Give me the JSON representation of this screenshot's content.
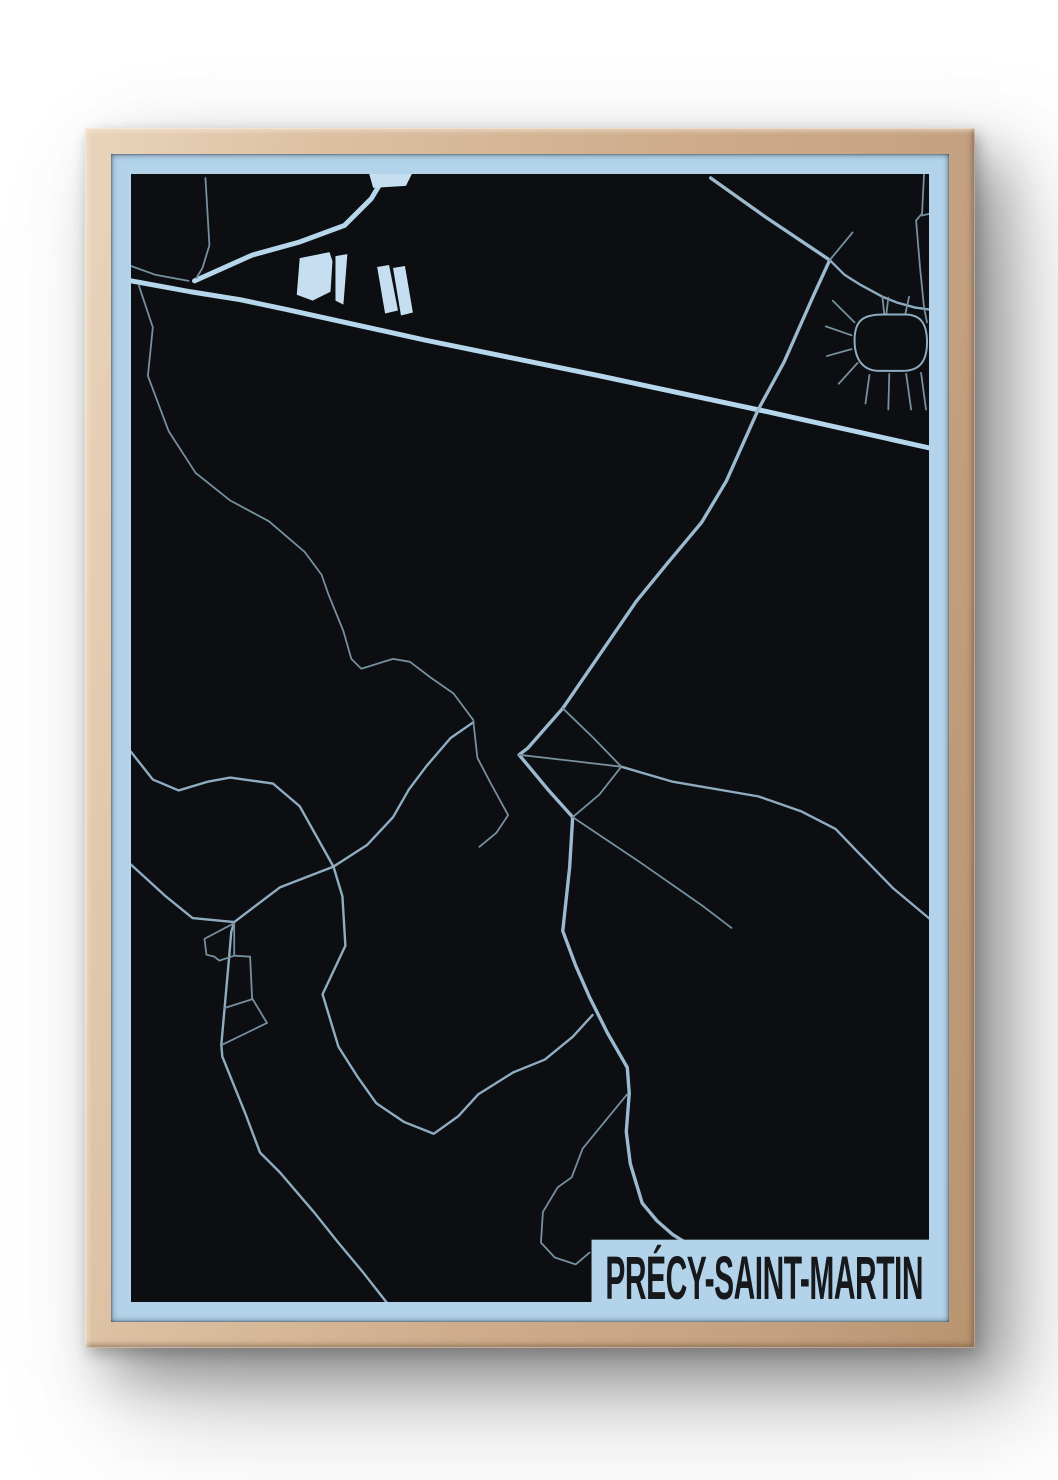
{
  "poster": {
    "title": "PRÉCY-SAINT-MARTIN",
    "type_label": "framed-city-map-poster",
    "colors": {
      "page_bg": "#ffffff",
      "frame_wood": "#cdab8b",
      "frame_wood_light": "#e9d4bc",
      "frame_wood_dark": "#b8946f",
      "matte_blue": "#b2d3ea",
      "map_black": "#0c0e11",
      "road_major": "#b6d7eb",
      "road_medium": "#9cbacf",
      "road_small": "#8fadc2",
      "road_minor": "#76909f",
      "building_fill": "#c6dff0",
      "band_bg": "#b2d3ea",
      "title_color": "#16181b"
    },
    "map": {
      "viewbox": "0 0 804 1140",
      "band": {
        "x": 464,
        "y": 1077,
        "w": 341,
        "h": 64
      },
      "title_text": {
        "x": 478,
        "y": 1137,
        "font_size": 62,
        "text_length": 320
      },
      "roads": {
        "major": {
          "width": 5,
          "paths": [
            [
              [
                0,
                108
              ],
              [
                60,
                119
              ],
              [
                110,
                127
              ],
              [
                157,
                137
              ],
              [
                297,
                168
              ],
              [
                472,
                204
              ],
              [
                640,
                240
              ],
              [
                805,
                277
              ]
            ],
            [
              [
                64,
                108
              ],
              [
                122,
                82
              ],
              [
                169,
                69
              ],
              [
                215,
                52
              ],
              [
                242,
                25
              ],
              [
                257,
                0
              ]
            ]
          ]
        },
        "medium": {
          "width": 3.4,
          "paths": [
            [
              [
                584,
                4
              ],
              [
                640,
                44
              ],
              [
                704,
                87
              ],
              [
                688,
                122
              ],
              [
                658,
                190
              ],
              [
                632,
                238
              ],
              [
                600,
                310
              ],
              [
                575,
                352
              ],
              [
                540,
                394
              ],
              [
                509,
                432
              ],
              [
                435,
                540
              ]
            ],
            [
              [
                435,
                540
              ],
              [
                400,
                580
              ],
              [
                391,
                587
              ],
              [
                420,
                622
              ],
              [
                445,
                650
              ],
              [
                442,
                700
              ],
              [
                435,
                765
              ],
              [
                448,
                800
              ],
              [
                462,
                832
              ],
              [
                480,
                868
              ],
              [
                500,
                903
              ],
              [
                502,
                929
              ],
              [
                499,
                968
              ],
              [
                503,
                1000
              ],
              [
                515,
                1040
              ],
              [
                530,
                1058
              ],
              [
                546,
                1072
              ],
              [
                562,
                1082
              ]
            ]
          ]
        },
        "small": {
          "width": 2.4,
          "paths": [
            [
              [
                494,
                599
              ],
              [
                545,
                614
              ],
              [
                632,
                629
              ],
              [
                675,
                644
              ],
              [
                710,
                662
              ],
              [
                732,
                685
              ],
              [
                768,
                722
              ],
              [
                805,
                753
              ]
            ],
            [
              [
                0,
                698
              ],
              [
                35,
                730
              ],
              [
                62,
                752
              ],
              [
                104,
                756
              ],
              [
                150,
                721
              ],
              [
                204,
                700
              ],
              [
                238,
                678
              ],
              [
                264,
                650
              ],
              [
                280,
                622
              ],
              [
                298,
                598
              ],
              [
                322,
                570
              ],
              [
                345,
                554
              ]
            ],
            [
              [
                0,
                584
              ],
              [
                22,
                612
              ],
              [
                48,
                623
              ],
              [
                78,
                614
              ],
              [
                100,
                610
              ],
              [
                143,
                616
              ],
              [
                170,
                639
              ],
              [
                204,
                700
              ],
              [
                213,
                730
              ],
              [
                216,
                780
              ],
              [
                193,
                829
              ],
              [
                209,
                882
              ],
              [
                228,
                912
              ],
              [
                247,
                939
              ],
              [
                275,
                958
              ],
              [
                305,
                970
              ],
              [
                330,
                952
              ],
              [
                350,
                930
              ],
              [
                385,
                908
              ],
              [
                417,
                895
              ],
              [
                445,
                872
              ],
              [
                465,
                850
              ]
            ],
            [
              [
                704,
                87
              ],
              [
                719,
                102
              ],
              [
                735,
                112
              ],
              [
                757,
                124
              ],
              [
                772,
                130
              ],
              [
                790,
                135
              ],
              [
                805,
                137
              ]
            ],
            [
              [
                104,
                756
              ],
              [
                101,
                766
              ],
              [
                99,
                790
              ],
              [
                95,
                835
              ],
              [
                91,
                880
              ],
              [
                92,
                892
              ],
              [
                115,
                949
              ],
              [
                130,
                989
              ],
              [
                150,
                1009
              ],
              [
                185,
                1050
              ],
              [
                208,
                1079
              ],
              [
                233,
                1109
              ],
              [
                258,
                1141
              ]
            ]
          ]
        },
        "minor": {
          "width": 1.8,
          "paths": [
            [
              [
                8,
                113
              ],
              [
                22,
                155
              ],
              [
                17,
                204
              ],
              [
                38,
                260
              ],
              [
                65,
                302
              ],
              [
                100,
                330
              ],
              [
                139,
                351
              ],
              [
                175,
                382
              ],
              [
                192,
                405
              ],
              [
                199,
                425
              ],
              [
                214,
                462
              ],
              [
                222,
                490
              ],
              [
                232,
                500
              ],
              [
                264,
                490
              ],
              [
                281,
                493
              ],
              [
                302,
                509
              ],
              [
                325,
                525
              ],
              [
                345,
                552
              ]
            ],
            [
              [
                75,
                4
              ],
              [
                79,
                72
              ],
              [
                72,
                95
              ],
              [
                66,
                105
              ]
            ],
            [
              [
                0,
                93
              ],
              [
                25,
                102
              ],
              [
                58,
                108
              ]
            ],
            [
              [
                345,
                554
              ],
              [
                349,
                590
              ],
              [
                362,
                615
              ],
              [
                380,
                648
              ],
              [
                368,
                666
              ],
              [
                351,
                680
              ]
            ],
            [
              [
                435,
                540
              ],
              [
                466,
                570
              ],
              [
                494,
                599
              ]
            ],
            [
              [
                391,
                587
              ],
              [
                443,
                593
              ],
              [
                494,
                599
              ]
            ],
            [
              [
                494,
                599
              ],
              [
                472,
                627
              ],
              [
                445,
                650
              ]
            ],
            [
              [
                445,
                650
              ],
              [
                512,
                695
              ],
              [
                575,
                739
              ],
              [
                605,
                762
              ]
            ],
            [
              [
                500,
                930
              ],
              [
                477,
                958
              ],
              [
                455,
                985
              ],
              [
                444,
                1014
              ],
              [
                430,
                1024
              ],
              [
                415,
                1049
              ],
              [
                413,
                1080
              ],
              [
                427,
                1095
              ],
              [
                448,
                1102
              ],
              [
                462,
                1090
              ]
            ],
            [
              [
                704,
                87
              ],
              [
                727,
                59
              ]
            ],
            [
              [
                799,
                0
              ],
              [
                797,
                40
              ],
              [
                791,
                47
              ],
              [
                795,
                95
              ],
              [
                799,
                135
              ],
              [
                802,
                150
              ]
            ],
            [
              [
                797,
                42
              ],
              [
                805,
                40
              ]
            ],
            [
              [
                104,
                757
              ],
              [
                74,
                773
              ],
              [
                76,
                789
              ],
              [
                84,
                791
              ],
              [
                89,
                795
              ],
              [
                104,
                790
              ],
              [
                104,
                757
              ]
            ],
            [
              [
                120,
                791
              ],
              [
                122,
                833
              ],
              [
                137,
                858
              ]
            ],
            [
              [
                104,
                790
              ],
              [
                120,
                791
              ]
            ],
            [
              [
                94,
                843
              ],
              [
                122,
                834
              ]
            ],
            [
              [
                92,
                880
              ],
              [
                137,
                858
              ]
            ],
            [
              [
                757,
                124
              ],
              [
                759,
                142
              ]
            ]
          ]
        },
        "spokes": {
          "width": 1.8,
          "paths": [
            [
              [
                729,
                150
              ],
              [
                707,
                128
              ]
            ],
            [
              [
                726,
                163
              ],
              [
                700,
                154
              ]
            ],
            [
              [
                726,
                177
              ],
              [
                701,
                184
              ]
            ],
            [
              [
                732,
                191
              ],
              [
                713,
                212
              ]
            ],
            [
              [
                744,
                203
              ],
              [
                740,
                232
              ]
            ],
            [
              [
                764,
                202
              ],
              [
                763,
                238
              ]
            ],
            [
              [
                781,
                202
              ],
              [
                786,
                238
              ]
            ],
            [
              [
                796,
                201
              ],
              [
                801,
                238
              ]
            ],
            [
              [
                761,
                142
              ],
              [
                763,
                125
              ]
            ],
            [
              [
                780,
                142
              ],
              [
                784,
                124
              ]
            ]
          ]
        }
      },
      "loop": {
        "width": 2,
        "d": "M729,168 C729,146 740,142 758,142 L780,142 C796,142 802,152 802,170 C802,190 794,199 777,199 L754,199 C738,199 729,188 729,168 Z"
      },
      "buildings": [
        [
          [
            240,
            0
          ],
          [
            283,
            0
          ],
          [
            277,
            12
          ],
          [
            244,
            14
          ]
        ],
        [
          [
            170,
            85
          ],
          [
            200,
            79
          ],
          [
            203,
            88
          ],
          [
            201,
            119
          ],
          [
            183,
            128
          ],
          [
            167,
            122
          ]
        ],
        [
          [
            206,
            83
          ],
          [
            218,
            81
          ],
          [
            214,
            132
          ],
          [
            206,
            128
          ]
        ],
        [
          [
            248,
            94
          ],
          [
            260,
            92
          ],
          [
            269,
            138
          ],
          [
            256,
            141
          ]
        ],
        [
          [
            264,
            95
          ],
          [
            276,
            93
          ],
          [
            284,
            140
          ],
          [
            272,
            143
          ]
        ]
      ]
    }
  }
}
